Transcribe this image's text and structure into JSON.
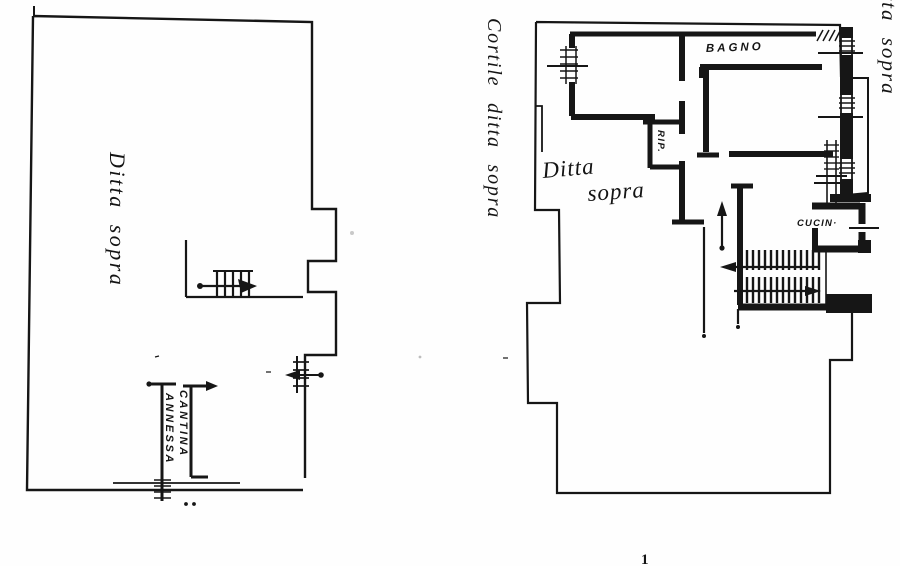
{
  "page": {
    "background": "#fefefe",
    "ink": "#161616"
  },
  "left_plan": {
    "label_ditta_sopra": "Ditta sopra",
    "label_cantina": "CANTINA",
    "label_annessa": "ANNESSA"
  },
  "right_plan": {
    "label_cortile_ditta_sopra": "Cortile ditta sopra",
    "label_bagno": "BAGNO",
    "label_rip": "RIP.",
    "label_ditta": "Ditta",
    "label_sopra": "sopra",
    "label_cucina": "CUCIN·",
    "label_ditta_sopra_edge": "ditta sopra"
  },
  "footer": {
    "page_mark": "1"
  }
}
